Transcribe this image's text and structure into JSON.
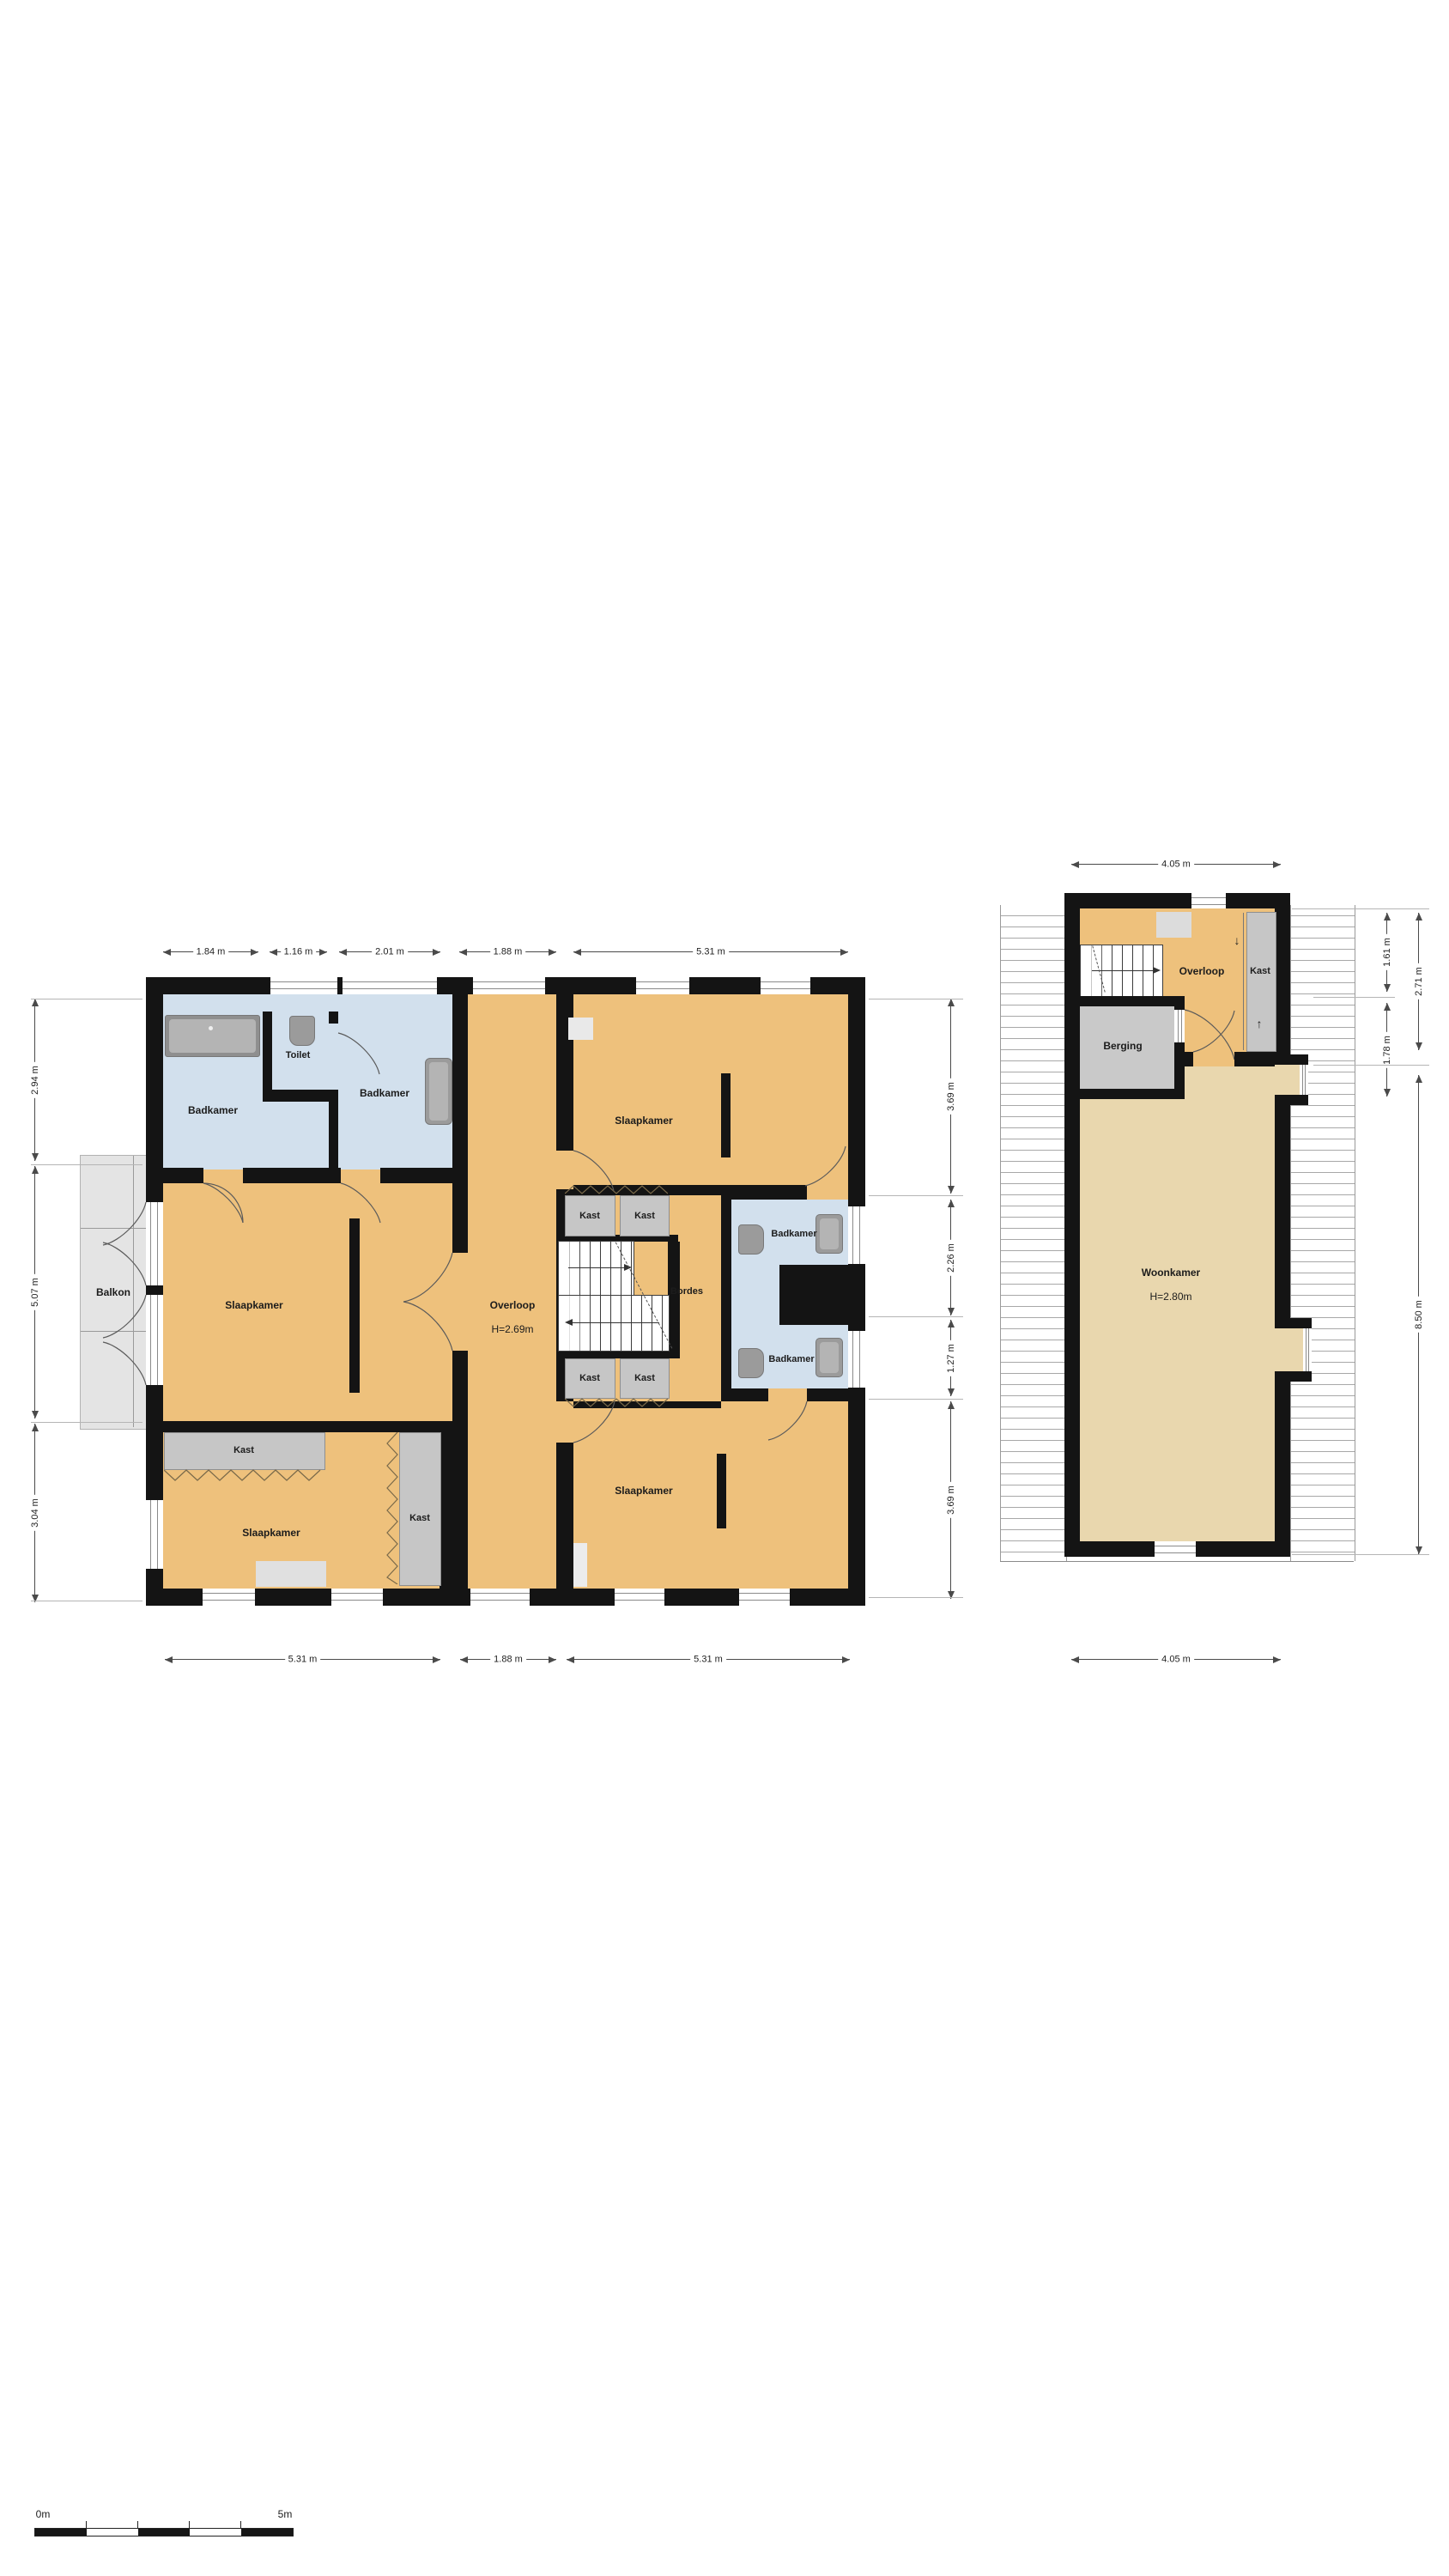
{
  "left_plan": {
    "dims_top": [
      "1.84 m",
      "1.16 m",
      "2.01 m",
      "1.88 m",
      "5.31 m"
    ],
    "dims_bottom": [
      "5.31 m",
      "1.88 m",
      "5.31 m"
    ],
    "dims_left": [
      "2.94 m",
      "5.07 m",
      "3.04 m"
    ],
    "dims_right": [
      "3.69 m",
      "2.26 m",
      "1.27 m",
      "3.69 m"
    ],
    "rooms": {
      "badkamer_nw": "Badkamer",
      "toilet": "Toilet",
      "badkamer_n": "Badkamer",
      "slaapkamer_w": "Slaapkamer",
      "balkon": "Balkon",
      "overloop": "Overloop",
      "overloop_h": "H=2.69m",
      "bordes": "Bordes",
      "slaapkamer_ne": "Slaapkamer",
      "badkamer_e1": "Badkamer",
      "badkamer_e2": "Badkamer",
      "kast_n1": "Kast",
      "kast_n2": "Kast",
      "kast_s1": "Kast",
      "kast_s2": "Kast",
      "kast_wide": "Kast",
      "kast_tall": "Kast",
      "slaapkamer_sw": "Slaapkamer",
      "slaapkamer_se": "Slaapkamer"
    }
  },
  "right_plan": {
    "dims_top": [
      "4.05 m"
    ],
    "dims_bottom": [
      "4.05 m"
    ],
    "dims_right_inner": [
      "1.61 m",
      "1.78 m"
    ],
    "dims_right_outer": [
      "2.71 m",
      "8.50 m"
    ],
    "rooms": {
      "overloop": "Overloop",
      "kast": "Kast",
      "berging": "Berging",
      "woonkamer": "Woonkamer",
      "woonkamer_h": "H=2.80m"
    }
  },
  "scale_bar": {
    "start": "0m",
    "end": "5m"
  },
  "colors": {
    "wall": "#141414",
    "room_orange": "#eec17c",
    "room_tan": "#e9d7ae",
    "room_blue": "#d2e0ed",
    "closet_gray": "#c6c6c6",
    "balkon_gray": "#e4e4e4"
  }
}
